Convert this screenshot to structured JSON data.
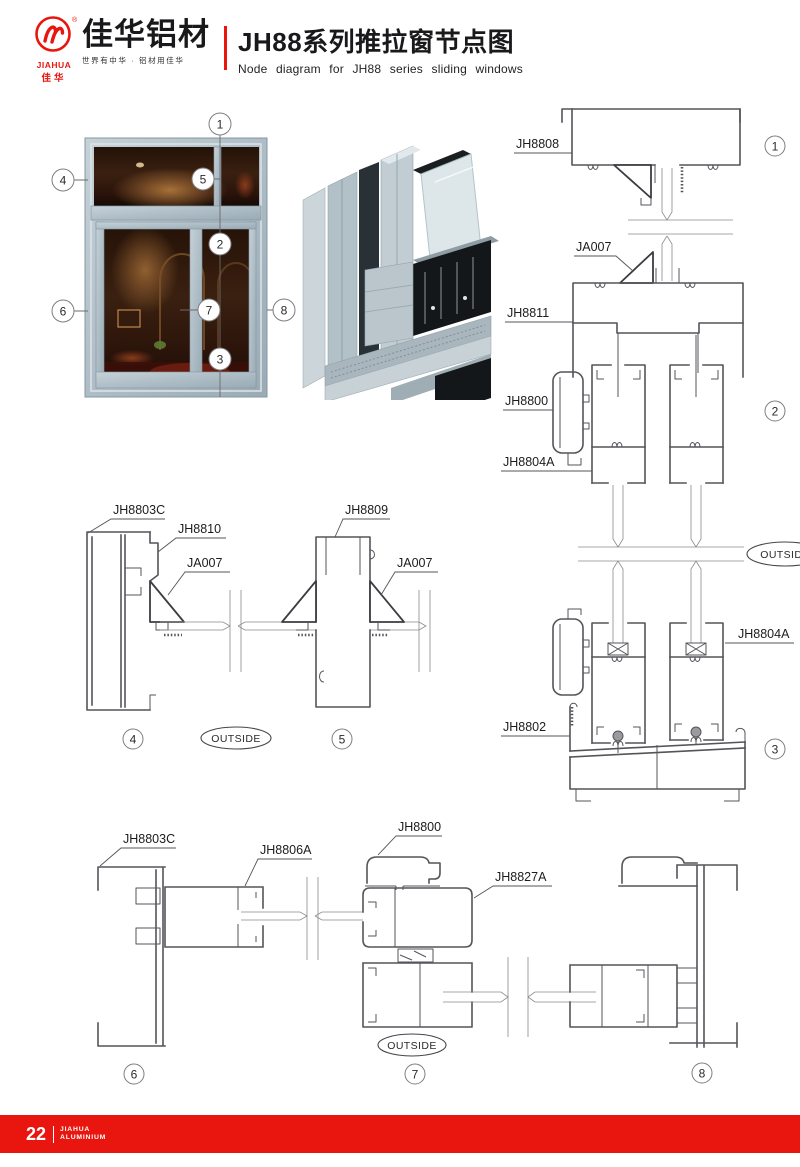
{
  "header": {
    "logo": {
      "brand_en": "JIAHUA",
      "brand_cn": "佳华",
      "registered": "®"
    },
    "brand_title": "佳华铝材",
    "brand_tagline": "世界有中华 · 铝材用佳华",
    "title_cn": "JH88系列推拉窗节点图",
    "title_en": "Node diagram for JH88 series sliding windows",
    "accent_color": "#e8160f"
  },
  "overview": {
    "callouts": {
      "c1": "1",
      "c2": "2",
      "c3": "3",
      "c4": "4",
      "c5": "5",
      "c6": "6",
      "c7": "7",
      "c8": "8"
    }
  },
  "diagram_right": {
    "jh8808": "JH8808",
    "ja007": "JA007",
    "jh8811": "JH8811",
    "jh8800": "JH8800",
    "jh8804a_left": "JH8804A",
    "jh8804a_right": "JH8804A",
    "jh8802": "JH8802",
    "outside": "OUTSIDE",
    "c1": "1",
    "c2": "2",
    "c3": "3"
  },
  "diagram_mid": {
    "jh8803c": "JH8803C",
    "jh8810": "JH8810",
    "ja007_left": "JA007",
    "jh8809": "JH8809",
    "ja007_right": "JA007",
    "outside": "OUTSIDE",
    "c4": "4",
    "c5": "5"
  },
  "diagram_bottom": {
    "jh8803c": "JH8803C",
    "jh8806a": "JH8806A",
    "jh8800": "JH8800",
    "jh8827a": "JH8827A",
    "outside": "OUTSIDE",
    "c6": "6",
    "c7": "7",
    "c8": "8"
  },
  "footer": {
    "page_number": "22",
    "brand_en_line1": "JIAHUA",
    "brand_en_line2": "ALUMINIUM"
  }
}
